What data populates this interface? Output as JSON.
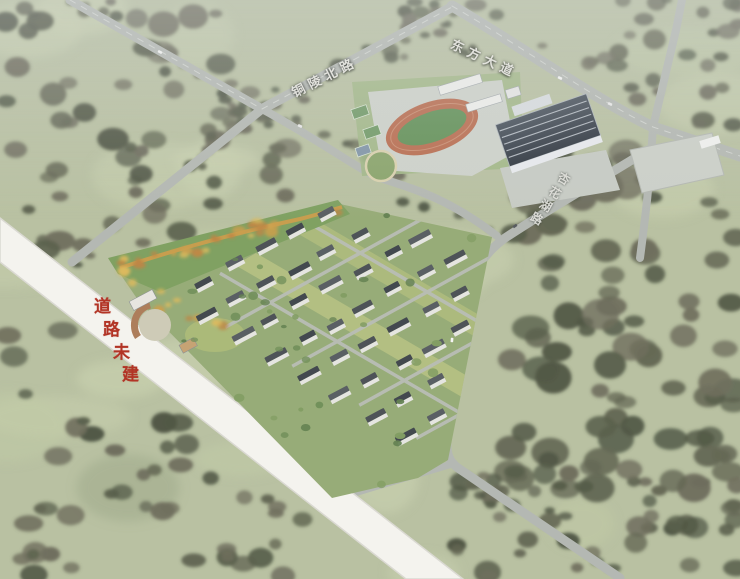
{
  "scene": {
    "description": "Aerial bird's-eye architectural rendering of a residential master plan with a stadium, school buildings, a large dark-roof hall, tree-covered fields and labelled roads",
    "width": 740,
    "height": 579
  },
  "labels": {
    "road_top_left": "铜陵北路",
    "road_top_right": "东方大道",
    "road_right": "杏花湖路",
    "unbuilt_notice": "道路未建"
  },
  "colors": {
    "field": "#b6c09c",
    "field_light": "#c6cfa8",
    "field_olive": "#9da985",
    "tree_dark1": "#565d47",
    "tree_dark2": "#626650",
    "tree_dark3": "#6d6c59",
    "tree_bright1": "#6d8f52",
    "tree_bright2": "#7d9c5a",
    "tree_bright3": "#5f814a",
    "orange_tree1": "#d09c3e",
    "orange_tree2": "#c28338",
    "orange_tree3": "#e0b84e",
    "road": "#b2b6b0",
    "road_line": "#dcded9",
    "unbuilt_road": "#f3f2ec",
    "notice_red": "#b23425",
    "site_green": "#93ab6f",
    "site_patch": "#b9c482",
    "lawn_strip": "#c9cd80",
    "park_green": "#7aa058",
    "plaza_gray": "#ccd0c8",
    "track_orange": "#c06a48",
    "pitch_green": "#5d9150",
    "building_face": "#e4e4df",
    "roof_a": "#4a5056",
    "roof_b": "#3f464d",
    "roof_c": "#565c62",
    "big_roof_dark": "#2e3640",
    "big_roof_light": "#46505c",
    "label_text": "#e9e9e4"
  }
}
